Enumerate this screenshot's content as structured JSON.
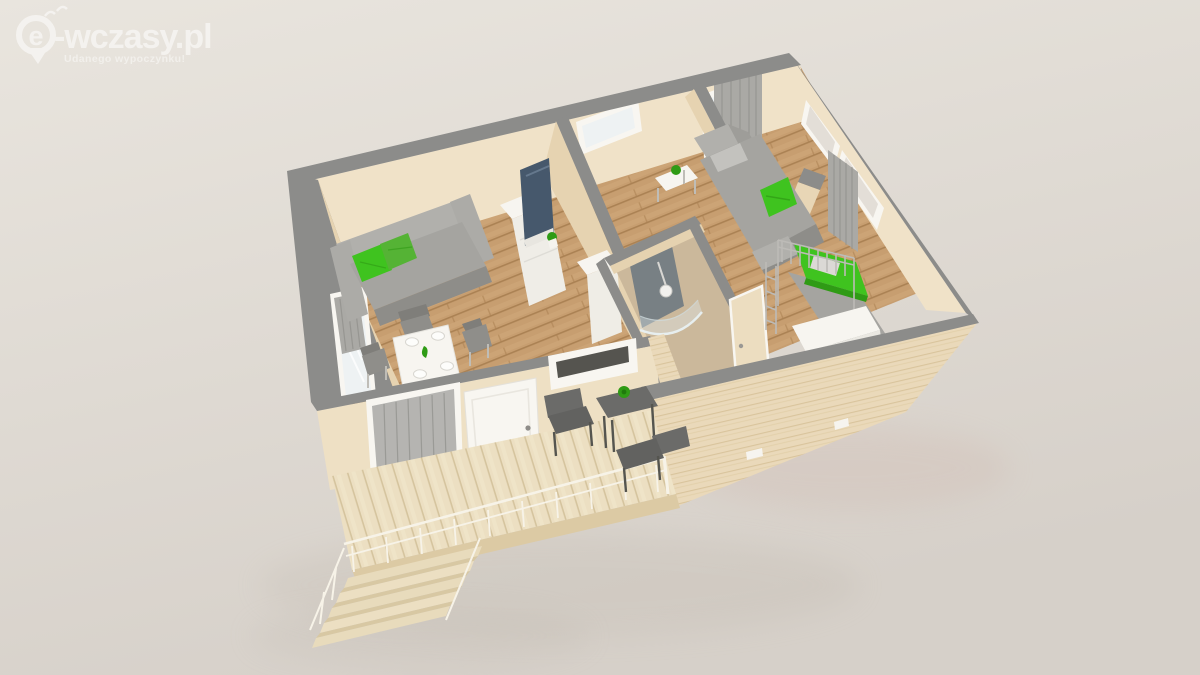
{
  "watermark": {
    "brand_letter": "e",
    "brand_text": "-wczasy.pl",
    "tagline": "Udanego wypoczynku!"
  },
  "palette": {
    "bg_top": "#e9e5de",
    "bg_bottom": "#d6d0c9",
    "wall_top": "#8c8c8a",
    "wall_face": "#f0e2c8",
    "wall_face_shade": "#e6d3b1",
    "wall_exterior": "#eee0c4",
    "floor_base": "#c79e70",
    "floor_stripe": "#ab8254",
    "floor_light": "#d2a97b",
    "bath_floor": "#cbb89b",
    "deck_base": "#ecdfc2",
    "deck_stripe": "#d5c49e",
    "deck_edge": "#dccaa4",
    "wood_base": "#ead9ba",
    "wood_grain": "#d9c49c",
    "frame_white": "#f8f6f1",
    "glass": "#eef2f3",
    "glass_bg": "#e3ded7",
    "curtain": "#aaa9a5",
    "sofa": "#a5a4a0",
    "sofa_light": "#b1b0ac",
    "sofa_dark": "#8e8d89",
    "green_accent": "#3fc31f",
    "green_alt": "#55b335",
    "green_dark": "#2f9b15",
    "white_furniture": "#f7f5f0",
    "chair_gray": "#8f8e8a",
    "tv_screen": "#46586c",
    "shower_tile": "#788084",
    "outdoor_dark": "#6b6b69",
    "watermark_white": "#ffffff"
  },
  "scene": {
    "rooms": [
      "living-room",
      "hallway",
      "second-room",
      "bathroom",
      "bedroom",
      "terrace"
    ]
  }
}
